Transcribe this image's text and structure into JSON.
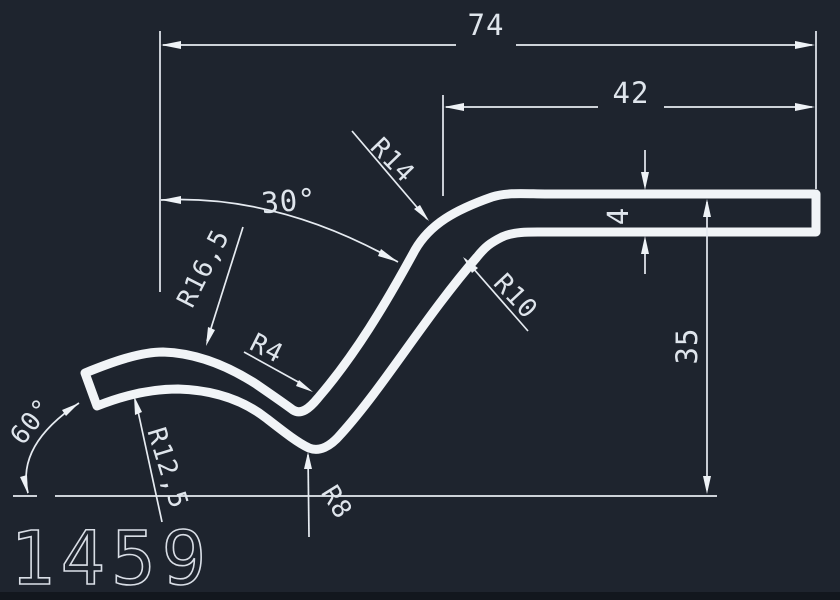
{
  "canvas": {
    "background_color": "#1e242e",
    "geometry_line_color": "#f1f4f7",
    "dimension_line_color": "#e6ebf1",
    "bottom_strip_color": "#12171e"
  },
  "part_label": "1459",
  "dims": {
    "total_width": "74",
    "upper_width": "42",
    "upper_angle": "30°",
    "thickness": "4",
    "height": "35",
    "end_angle": "60°",
    "bend_outer_radius": "R14",
    "bend_inner_radius": "R10",
    "hump_outer_radius": "R16,5",
    "hump_inner_radius": "R12,5",
    "valley_upper_radius": "R4",
    "valley_lower_radius": "R8"
  }
}
